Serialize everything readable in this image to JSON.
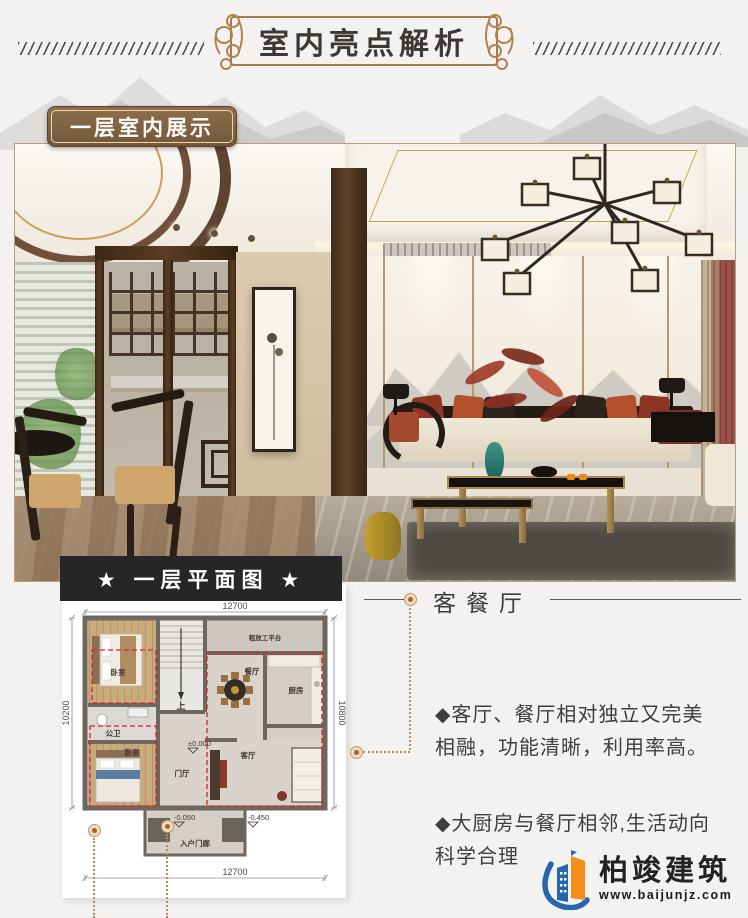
{
  "header": {
    "title": "室内亮点解析"
  },
  "section": {
    "label": "一层室内展示"
  },
  "floor_plan": {
    "banner": "★ 一层平面图 ★",
    "dim_top": "12700",
    "dim_bottom": "12700",
    "dim_left": "10200",
    "dim_right": "10800",
    "level_zero": "±0.000",
    "level_porch": "-0.050",
    "level_outside": "-0.450",
    "room_bedroom_top": "卧室",
    "room_bath": "公卫",
    "room_bedroom_bottom": "卧室",
    "room_foyer": "门厅",
    "room_living": "客厅",
    "room_dining": "餐厅",
    "room_kitchen": "厨房",
    "room_terrace": "粗放工平台",
    "room_porch": "入户门廊",
    "stairs_up": "上"
  },
  "callout": {
    "title": "客餐厅"
  },
  "bullets": {
    "b1": "◆客厅、餐厅相对独立又完美相融，功能清晰，利用率高。",
    "b2": "◆大厨房与餐厅相邻,生活动向科学合理"
  },
  "logo": {
    "name": "柏竣建筑",
    "site": "www.baijunjz.com"
  },
  "colors": {
    "frame_gold": "#a97a49",
    "plaque_brown": "#7d6143",
    "banner_black": "#262626",
    "plan_dash_red": "#e02020",
    "leader_tan": "#ba8d57",
    "logo_blue": "#2566ad",
    "logo_orange": "#f28f17"
  }
}
